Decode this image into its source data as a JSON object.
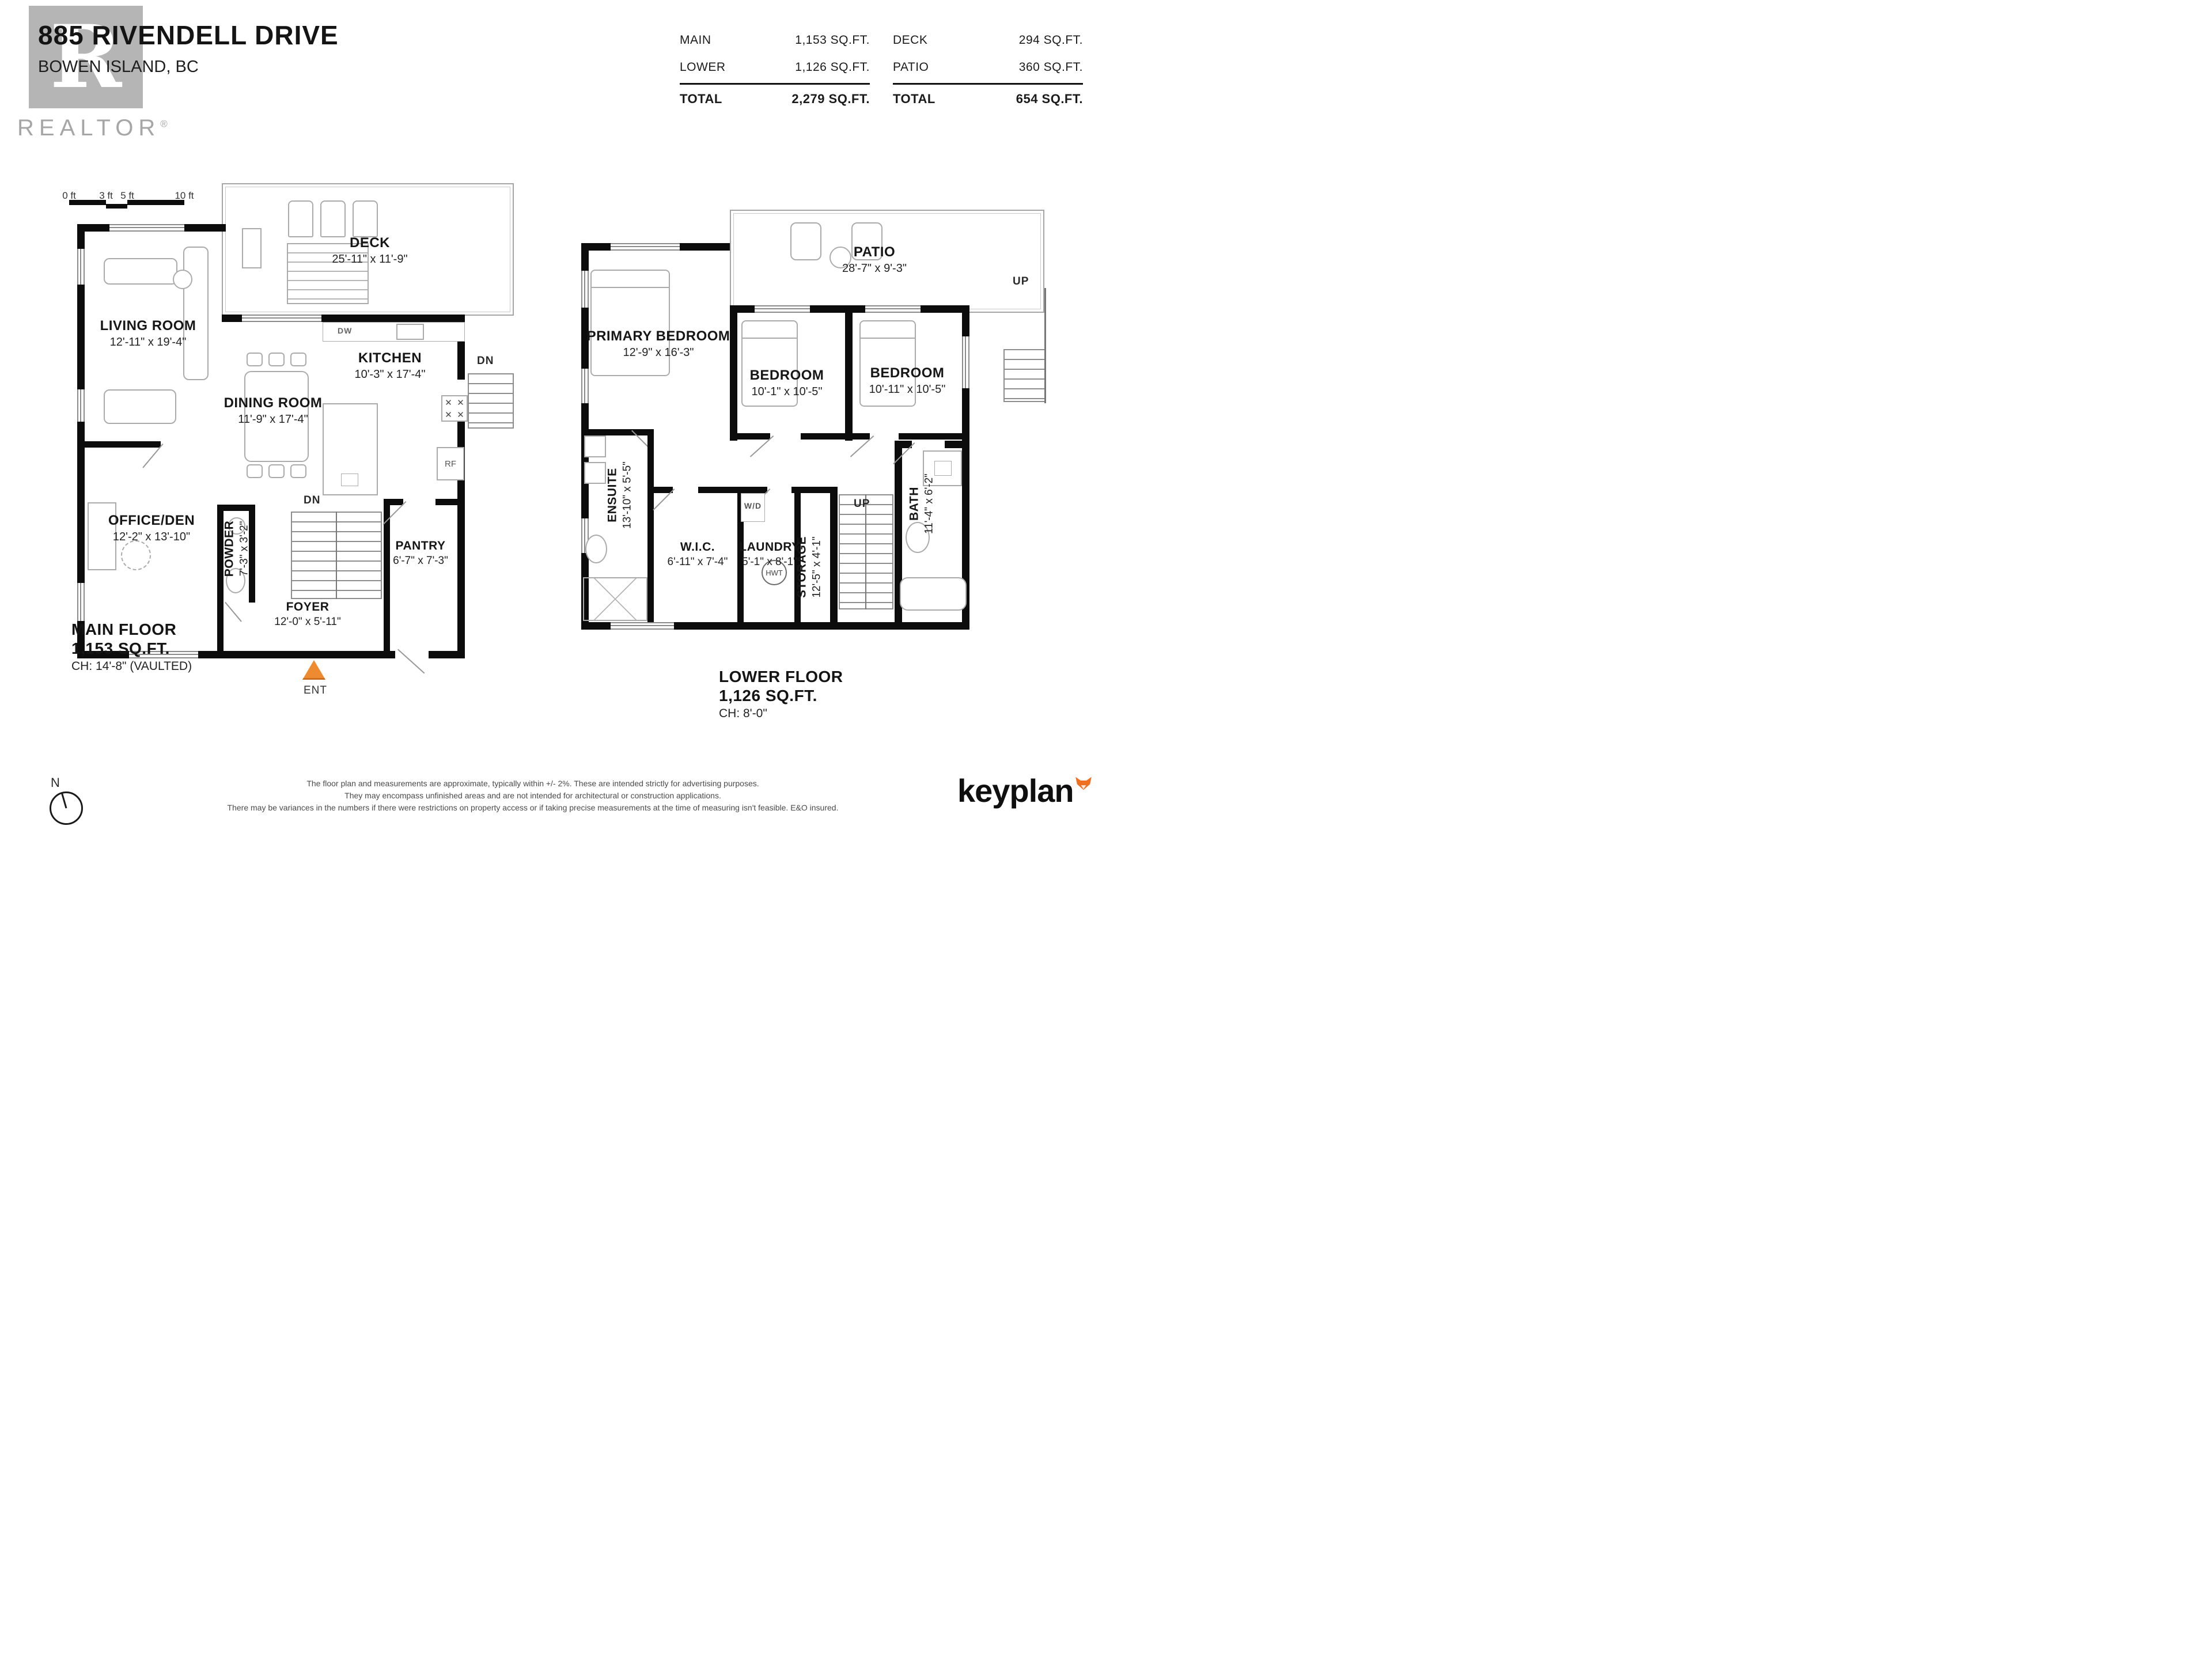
{
  "header": {
    "address_line1": "885 RIVENDELL DRIVE",
    "address_line2": "BOWEN ISLAND, BC",
    "realtor_wordmark": "REALTOR",
    "registered": "®",
    "logo_letter": "R"
  },
  "areas": {
    "interior": {
      "rows": [
        {
          "label": "MAIN",
          "value": "1,153 SQ.FT."
        },
        {
          "label": "LOWER",
          "value": "1,126 SQ.FT."
        }
      ],
      "total_label": "TOTAL",
      "total_value": "2,279 SQ.FT."
    },
    "exterior": {
      "rows": [
        {
          "label": "DECK",
          "value": "294 SQ.FT."
        },
        {
          "label": "PATIO",
          "value": "360 SQ.FT."
        }
      ],
      "total_label": "TOTAL",
      "total_value": "654 SQ.FT."
    }
  },
  "scale_bar": {
    "t0": "0 ft",
    "t1": "3 ft",
    "t2": "5 ft",
    "t3": "10 ft"
  },
  "main_floor": {
    "deck": {
      "name": "DECK",
      "dims": "25'-11\" x 11'-9\""
    },
    "living": {
      "name": "LIVING ROOM",
      "dims": "12'-11\" x 19'-4\""
    },
    "kitchen": {
      "name": "KITCHEN",
      "dims": "10'-3\" x 17'-4\""
    },
    "dining": {
      "name": "DINING ROOM",
      "dims": "11'-9\" x 17'-4\""
    },
    "office": {
      "name": "OFFICE/DEN",
      "dims": "12'-2\" x 13'-10\""
    },
    "powder": {
      "name": "POWDER",
      "dims": "7'-3\" x 3'-2\""
    },
    "pantry": {
      "name": "PANTRY",
      "dims": "6'-7\" x 7'-3\""
    },
    "foyer": {
      "name": "FOYER",
      "dims": "12'-0\" x 5'-11\""
    },
    "title": "MAIN FLOOR",
    "area": "1,153 SQ.FT.",
    "ceiling": "CH: 14'-8\" (VAULTED)",
    "markers": {
      "dn_stairs": "DN",
      "dn_exterior": "DN",
      "dw": "DW",
      "rf": "RF",
      "ent": "ENT"
    }
  },
  "lower_floor": {
    "patio": {
      "name": "PATIO",
      "dims": "28'-7\" x 9'-3\""
    },
    "primary": {
      "name": "PRIMARY BEDROOM",
      "dims": "12'-9\" x 16'-3\""
    },
    "bedroom2": {
      "name": "BEDROOM",
      "dims": "10'-1\" x 10'-5\""
    },
    "bedroom3": {
      "name": "BEDROOM",
      "dims": "10'-11\" x 10'-5\""
    },
    "ensuite": {
      "name": "ENSUITE",
      "dims": "13'-10\" x 5'-5\""
    },
    "wic": {
      "name": "W.I.C.",
      "dims": "6'-11\" x 7'-4\""
    },
    "laundry": {
      "name": "LAUNDRY",
      "dims": "5'-1\" x 8'-1\""
    },
    "storage": {
      "name": "STORAGE",
      "dims": "12'-5\" x 4'-1\""
    },
    "bath": {
      "name": "BATH",
      "dims": "11'-4\" x 6'-2\""
    },
    "title": "LOWER FLOOR",
    "area": "1,126 SQ.FT.",
    "ceiling": "CH: 8'-0\"",
    "markers": {
      "up_stairs": "UP",
      "up_exterior": "UP",
      "wd": "W/D",
      "hwt": "HWT"
    }
  },
  "footer": {
    "compass_label": "N",
    "disclaimer_line1": "The floor plan and measurements are approximate, typically within +/- 2%. These are intended strictly for advertising purposes.",
    "disclaimer_line2": "They may encompass unfinished areas and are not intended for architectural or construction applications.",
    "disclaimer_line3": "There may be variances in the numbers if there were restrictions on property access or if taking precise measurements at the time of measuring isn't feasible. E&O insured.",
    "brand": "keyplan"
  },
  "colors": {
    "wall": "#0c0c0c",
    "furniture_line": "#ababab",
    "ent_orange": "#ee8a2f",
    "brand_orange": "#f07021",
    "watermark_gray": "#b5b5b5"
  }
}
